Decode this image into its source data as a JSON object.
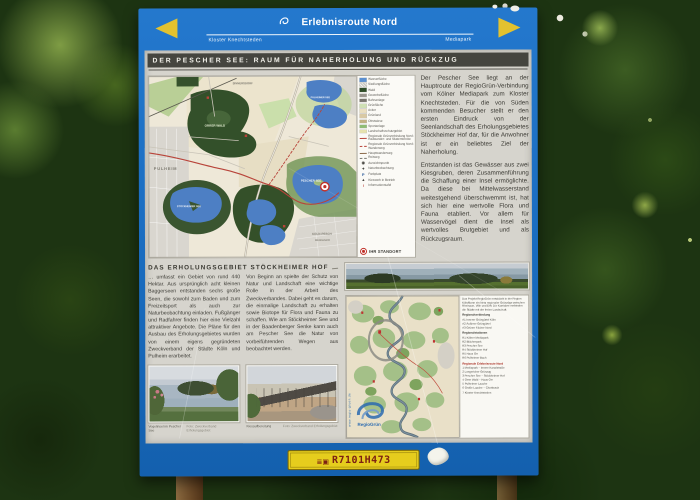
{
  "colors": {
    "sign_blue": "#1b6ec2",
    "arrow_yellow": "#e3c22f",
    "panel_gray": "#d6d4cd",
    "titlebar": "#45453f",
    "accent_red": "#b8443a",
    "water_blue": "#4d7fc4",
    "sticker_yellow": "#e6cd1d",
    "sticker_text": "#7c2012"
  },
  "header": {
    "route_name": "Erlebnisroute Nord",
    "left_destination": "Kloster Knechtsteden",
    "right_destination": "Mediapark"
  },
  "title": "DER PESCHER SEE: RAUM FÜR NAHERHOLUNG UND RÜCKZUG",
  "intro": {
    "p1": "Der Pescher See liegt an der Hauptroute der RegioGrün-Verbindung vom Kölner Mediapark zum Kloster Knechtsteden. Für die von Süden kommenden Besucher stellt er den ersten Eindruck von der Seenlandschaft des Erholungsgebietes Stöckheimer Hof dar, für die Anwohner ist er ein beliebtes Ziel der Naherholung.",
    "p2": "Entstanden ist das Gewässer aus zwei Kiesgruben, deren Zusammenführung die Schaffung einer Insel ermöglichte. Da diese bei Mittelwasserstand weitestgehend überschwemmt ist, hat sich hier eine wertvolle Flora und Fauna etabliert. Vor allem für Wasservögel dient die Insel als wertvolles Brutgebiet und als Rückzugsraum."
  },
  "map": {
    "labels": {
      "pulheim": "PULHEIM",
      "sinnersdorf": "SINNERSDORF",
      "orrer_wald": "ORRER WALD",
      "lake_ne": "PULHEIMER SEE",
      "pescher_see": "PESCHER SEE",
      "stoeckheimer_see": "STÖCKHEIMER SEE",
      "koeln_pesch": "KÖLN-PESCH",
      "mengenich": "MENGENICH"
    },
    "legend": {
      "items": [
        {
          "type": "fill",
          "color": "#5b8fd0",
          "label": "Wasserfläche"
        },
        {
          "type": "fill",
          "color": "#c9c6bf",
          "hatch": true,
          "label": "Siedlungsfläche"
        },
        {
          "type": "fill",
          "color": "#2f4d28",
          "label": "Wald"
        },
        {
          "type": "fill",
          "color": "#9b978f",
          "label": "Gewerbefläche"
        },
        {
          "type": "fill",
          "color": "#7a776f",
          "label": "Bahnanlage"
        },
        {
          "type": "fill",
          "color": "#cfe0b4",
          "label": "Grünfläche"
        },
        {
          "type": "fill",
          "color": "#eadfc0",
          "label": "Acker"
        },
        {
          "type": "fill",
          "color": "#d9c9a4",
          "label": "Grünland"
        },
        {
          "type": "fill",
          "color": "#c2b183",
          "label": "Obstwiese"
        },
        {
          "type": "fill",
          "color": "#8fbc74",
          "label": "Sportanlage"
        },
        {
          "type": "fill",
          "color": "#e6e2ae",
          "label": "Landschaftsschutzgebiet"
        },
        {
          "type": "line",
          "color": "#b8443a",
          "label": "Regionale Grünverbindung Nord: Radwander- und Skaterstrecke"
        },
        {
          "type": "dash",
          "color": "#b8443a",
          "label": "Regionale Grünverbindung Nord: Wanderweg"
        },
        {
          "type": "line",
          "color": "#8a6a4a",
          "label": "Hauptwanderweg"
        },
        {
          "type": "dash",
          "color": "#777770",
          "label": "Reitweg"
        },
        {
          "type": "sym",
          "glyph": "◉",
          "color": "#44433d",
          "label": "Aussichtspunkt"
        },
        {
          "type": "sym",
          "glyph": "✦",
          "color": "#44433d",
          "label": "Naturbeobachtung"
        },
        {
          "type": "sym",
          "glyph": "P",
          "color": "#2a5a9a",
          "label": "Parkplatz"
        },
        {
          "type": "sym",
          "glyph": "▲",
          "color": "#44433d",
          "label": "Kieswerk in Betrieb"
        },
        {
          "type": "sym",
          "glyph": "i",
          "color": "#b8443a",
          "label": "Informationstafel"
        }
      ],
      "standort": "IHR STANDORT"
    }
  },
  "section": {
    "heading": "DAS ERHOLUNGSGEBIET STÖCKHEIMER HOF",
    "col1": "… umfasst ein Gebiet von rund 440 Hektar. Aus ursprünglich acht kleinen Baggerseen entstanden sechs große Seen, die sowohl zum Baden und zum Freizeitsport als auch zur Naturbeobachtung einladen. Fußgänger und Radfahrer finden hier eine Vielzahl attraktiver Angebote. Die Pläne für den Ausbau des Erholungsgebietes wurden von einem eigens gegründeten Zweckverband der Städte Köln und Pulheim erarbeitet.",
    "col2": "Von Beginn an spielte der Schutz von Natur und Landschaft eine wichtige Rolle in der Arbeit des Zweckverbandes. Dabei geht es darum, die einmalige Landschaft zu erhalten sowie Biotope für Flora und Fauna zu schaffen. Wie am Stöckheimer See und in der Baadenberger Senke kann auch am Pescher See die Natur von vorbeiführenden Wegen aus beobachtet werden."
  },
  "photos": [
    {
      "caption": "Vogelinsel im Pescher See",
      "credit": "Foto: Zweckverband Erholungsgebiet"
    },
    {
      "caption": "Kiesaufbereitung",
      "credit": "Foto: Zweckverband Erholungsgebiet"
    }
  ],
  "regio": {
    "intro": "Das Projekt RegioGrün entwickelt in der Region Köln/Bonn ein Netz regionaler Grünzüge zwischen Rheinaue, Ville und Erft. Die Korridore verbinden die Städte mit der freien Landschaft.",
    "sections": [
      {
        "title": "Regionalverbindung",
        "red": false,
        "items": [
          "A1 Innerer Grüngürtel Köln",
          "A2 Äußerer Grüngürtel",
          "A3 Grüner Fächer Nord"
        ]
      },
      {
        "title": "Regionalstationen",
        "red": false,
        "items": [
          "R1 Kölner Mediapark",
          "R2 Blücherpark",
          "R3 Pescher See",
          "R4 Stöckheimer Hof",
          "R5 Haus Orr",
          "R6 Pulheimer Bach"
        ]
      },
      {
        "title": "Regionale Erlebnisroute Nord",
        "red": true,
        "items": [
          "1 Mediapark – Innere Kanalstraße",
          "2 Longericher Grünzug",
          "3 Pescher See – Stöckheimer Hof",
          "4 Orrer Wald – Haus Orr",
          "5 Pulheimer Laache",
          "6 Große Laache – Chorbusch",
          "7 Kloster Knechtsteden"
        ]
      }
    ],
    "logo_text": "RegioGrün",
    "url": "www.regio-gruen.de",
    "partner_logos": [
      {
        "name": "zweckverband-logo",
        "color": "#8a96a2"
      },
      {
        "name": "wave-logo",
        "color": "#aab4bc"
      },
      {
        "name": "regionale-2010-logo",
        "color": "#c03030"
      },
      {
        "name": "nrw-logo",
        "color": "#8a9a4a"
      },
      {
        "name": "stadt-koeln-logo",
        "color": "#667082"
      },
      {
        "name": "stadt-pulheim-logo",
        "color": "#99a2aa"
      },
      {
        "name": "rhein-erft-kreis-logo",
        "color": "#447799"
      },
      {
        "name": "eu-logo",
        "color": "#3a5a9a"
      }
    ]
  },
  "footer": {
    "sticker_code": "R7101H473",
    "sticker_icons": [
      {
        "name": "menu-lines-icon",
        "glyph": "≣"
      },
      {
        "name": "frame-icon",
        "glyph": "▣"
      }
    ]
  }
}
